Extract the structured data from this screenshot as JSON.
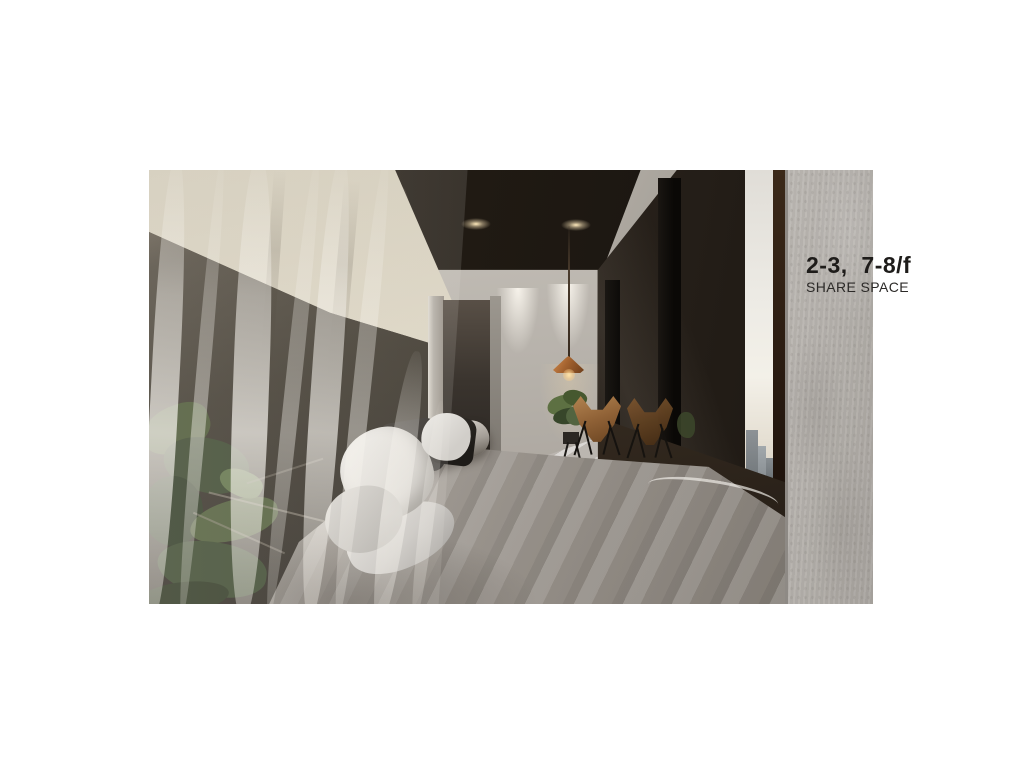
{
  "caption": {
    "title": "2-3,  7-8/f",
    "subtitle": "SHARE SPACE",
    "text_color": "#1f1d1b"
  },
  "scene": {
    "description": "3D interior rendering of a share-space bedroom: low bed with grey duvet and pillows, sheer curtains over plants on the left, cove-lit cream wall band, dark ceiling with recessed downlights, copper pendant lamp, potted plant, two leather butterfly chairs, dark bronze glass partition with a narrow city-view opening, and a concrete column on the right",
    "objects": [
      "cove-lit-wall",
      "dark-ceiling",
      "recessed-downlights",
      "sheer-curtains",
      "plants",
      "bed",
      "duvet-roll",
      "pillows",
      "copper-pendant-lamp",
      "potted-plant",
      "butterfly-chair",
      "butterfly-chair-reflection",
      "steel-posts",
      "glass-partition",
      "city-view",
      "striped-floor",
      "concrete-column"
    ]
  },
  "palette": {
    "page_background": "#ffffff",
    "ceiling": "#1e1813",
    "cove_wall": "#eae3d0",
    "dark_wall": "#332d26",
    "back_wall": "#b5afa8",
    "bed": "#9b958e",
    "pillow_white": "#e9e7e3",
    "chair_leather": "#8a5c32",
    "pendant_copper": "#a3622f",
    "glass": "#241e18",
    "sky": "#efece6",
    "concrete_column": "#b2aeaa",
    "caption_text": "#1f1d1b"
  }
}
